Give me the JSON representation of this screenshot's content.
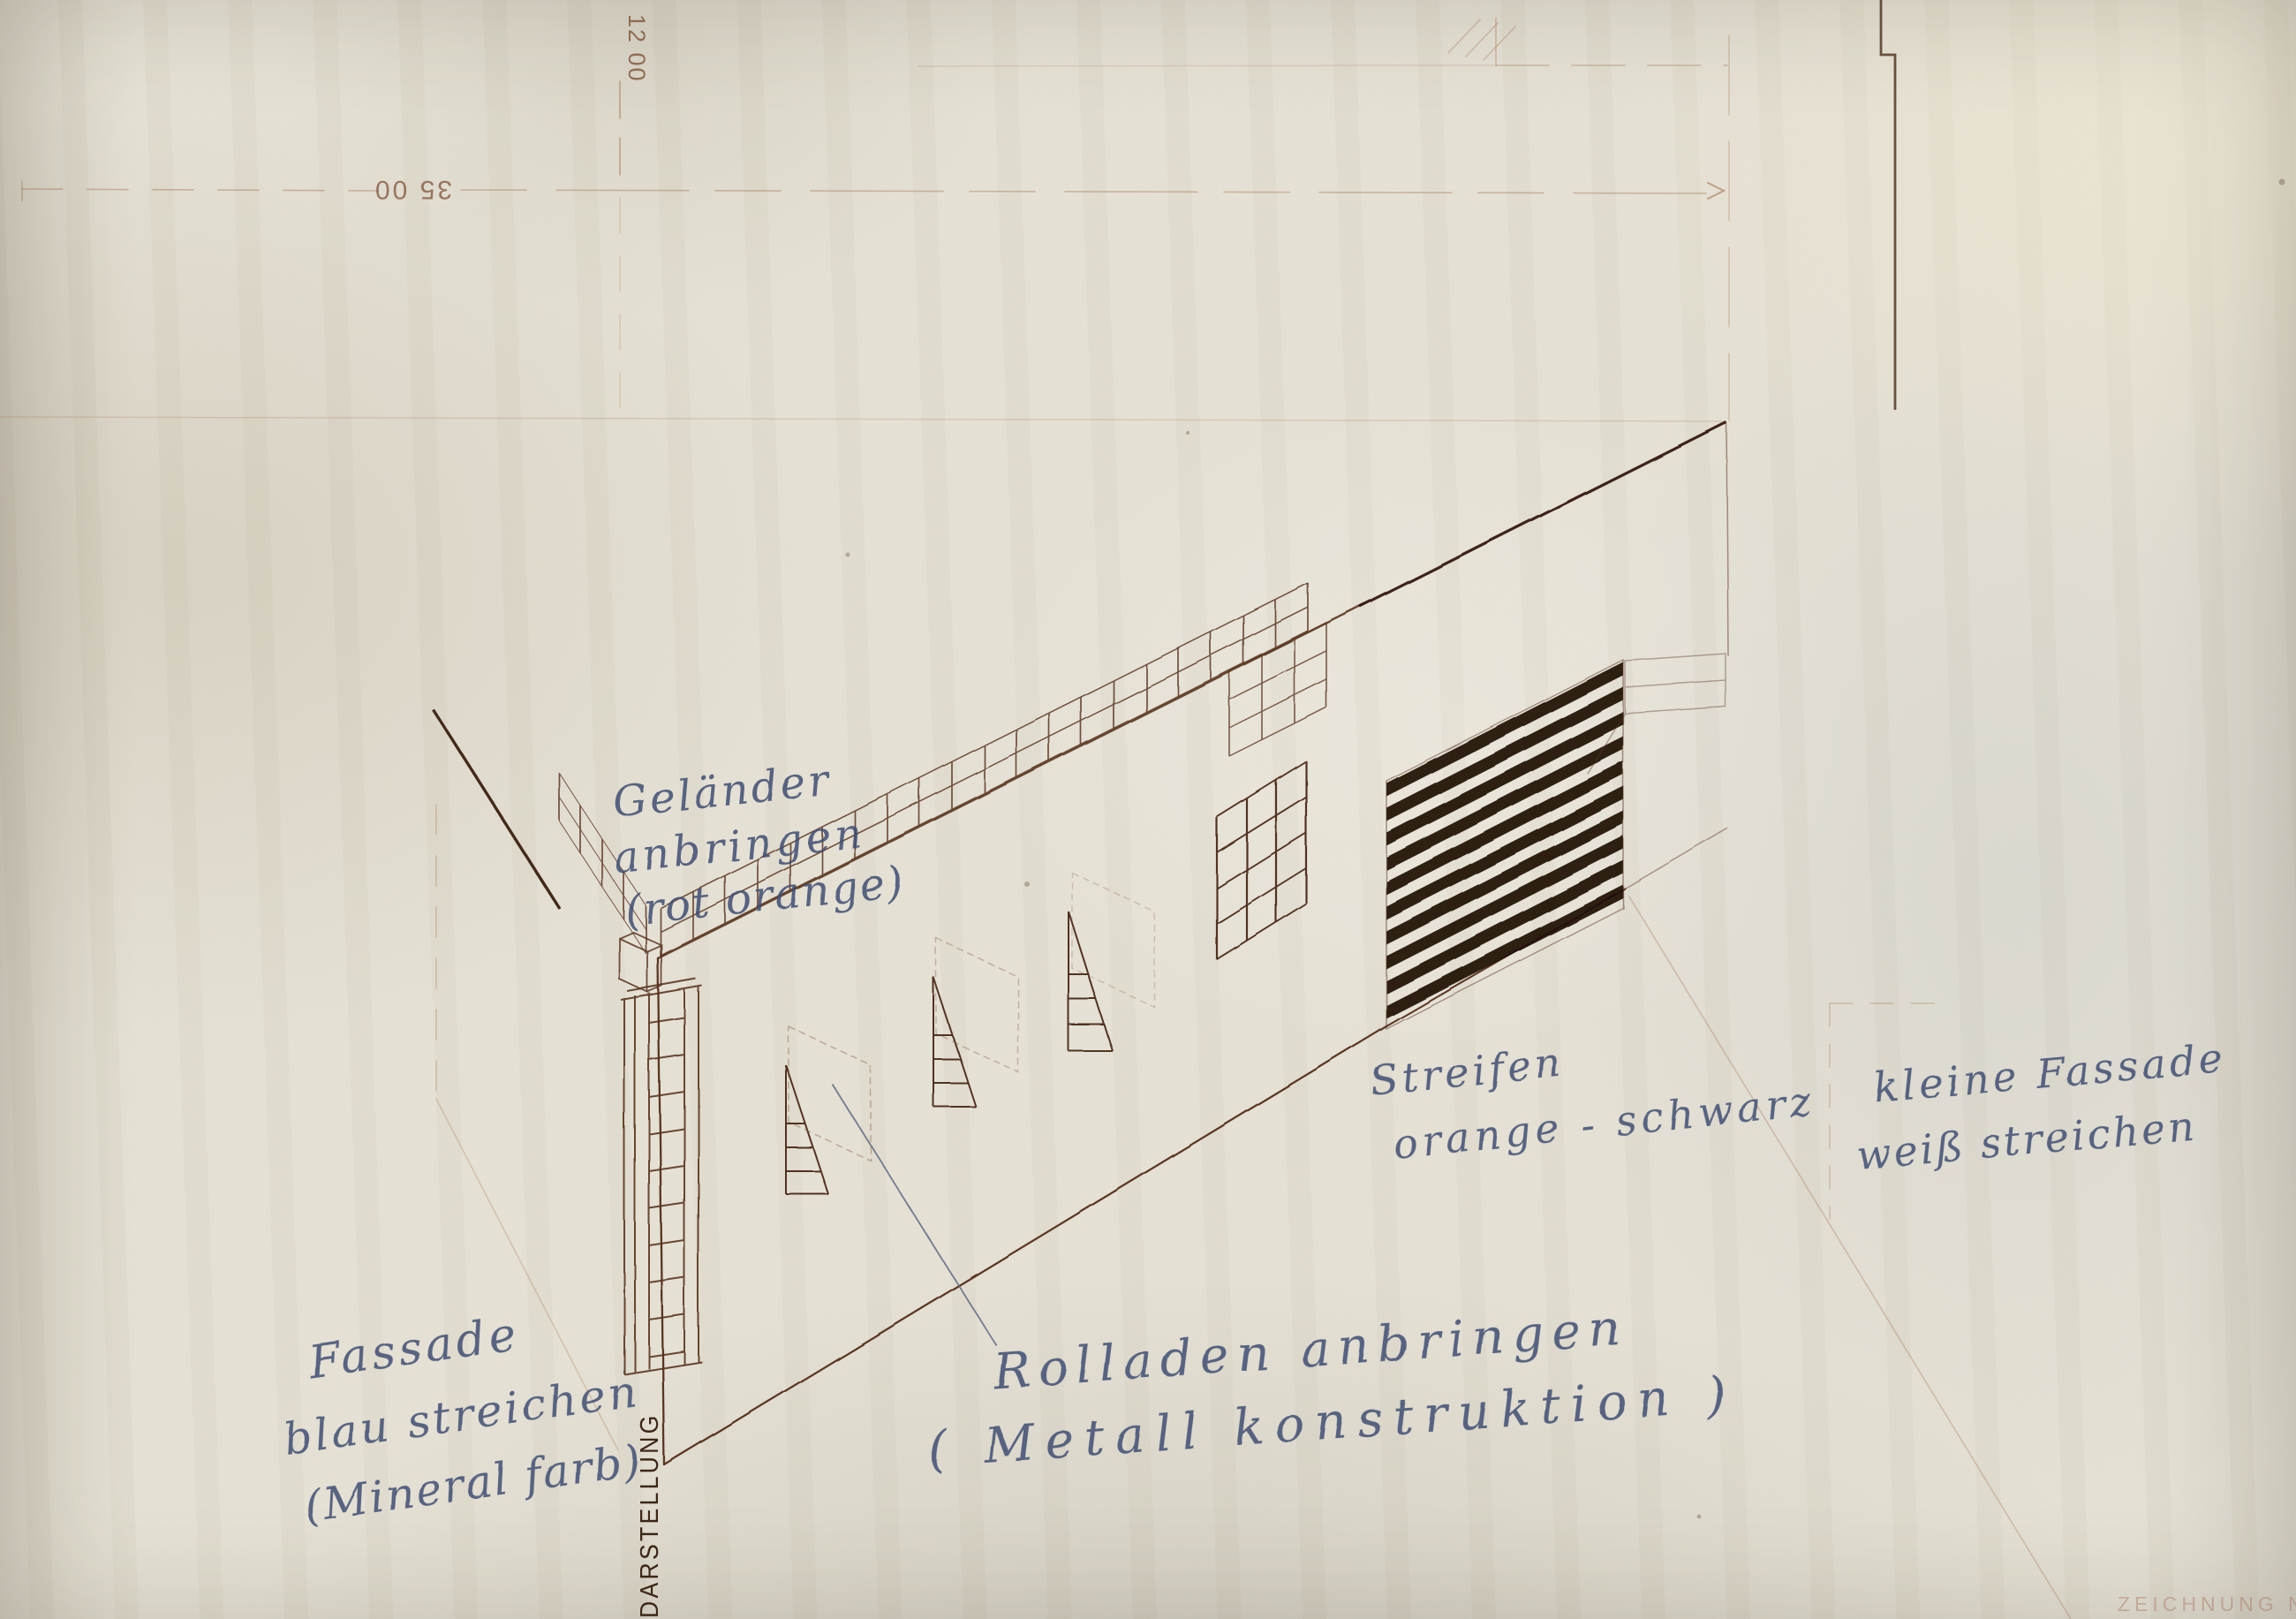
{
  "annotations": {
    "gelaender": {
      "lines": [
        "Geländer",
        "anbringen",
        "(rot orange)"
      ]
    },
    "fassade_blau": {
      "lines": [
        "Fassade",
        "blau streichen",
        "(Mineral farb)"
      ]
    },
    "rolladen": {
      "lines": [
        "Rolladen anbringen",
        "( Metall konstruktion )"
      ]
    },
    "streifen": {
      "lines": [
        "Streifen",
        "orange - schwarz"
      ]
    },
    "kleine_fassade": {
      "lines": [
        "kleine Fassade",
        "weiß streichen"
      ]
    }
  },
  "dimensions": {
    "width_label": "35 00",
    "height_label": "12 00"
  },
  "titles": {
    "side_label": "DARSTELLUNG",
    "stamp": "ZEICHNUNG NR 6"
  },
  "colors": {
    "paper": "#e7e3d6",
    "ink_sepia": "#5a3420",
    "ink_dark": "#33180c",
    "ink_blue": "#3e4d74",
    "stripe_black": "#1d0f07",
    "construction_faint": "#a06a45"
  }
}
